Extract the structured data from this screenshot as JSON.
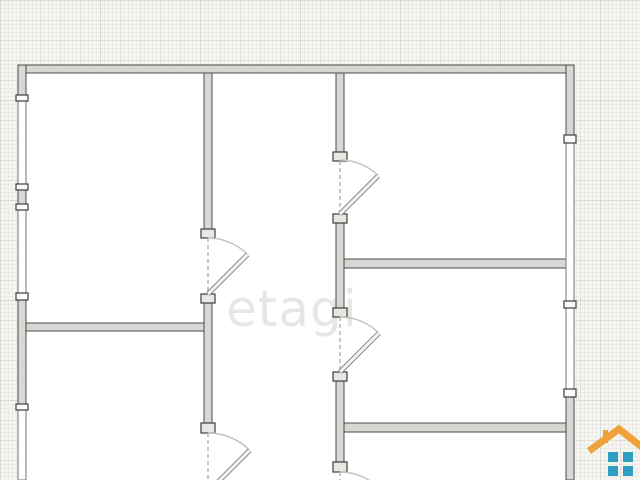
{
  "watermark": {
    "text": "etagi"
  },
  "logo": {
    "name": "house-logo",
    "roof_color": "#F0A23A",
    "pane_color": "#2E9FC0"
  },
  "plan": {
    "colors": {
      "wall_fill": "#D9D7D3",
      "wall_outline": "#4B4B4B",
      "interior": "#FFFFFF"
    },
    "rects": [
      {
        "t": "wall",
        "x": 18,
        "y": 65,
        "w": 556,
        "h": 8
      },
      {
        "t": "wall",
        "x": 18,
        "y": 65,
        "w": 8,
        "h": 30
      },
      {
        "t": "wall",
        "x": 18,
        "y": 190,
        "w": 8,
        "h": 14
      },
      {
        "t": "wall",
        "x": 18,
        "y": 300,
        "w": 8,
        "h": 104
      },
      {
        "t": "wall",
        "x": 566,
        "y": 65,
        "w": 8,
        "h": 70
      },
      {
        "t": "wall",
        "x": 566,
        "y": 397,
        "w": 8,
        "h": 83
      },
      {
        "t": "wall",
        "x": 204,
        "y": 73,
        "w": 8,
        "h": 157
      },
      {
        "t": "wall",
        "x": 204,
        "y": 303,
        "w": 8,
        "h": 120
      },
      {
        "t": "wall",
        "x": 336,
        "y": 73,
        "w": 8,
        "h": 79
      },
      {
        "t": "wall",
        "x": 336,
        "y": 223,
        "w": 8,
        "h": 86
      },
      {
        "t": "wall",
        "x": 336,
        "y": 381,
        "w": 8,
        "h": 81
      },
      {
        "t": "wall",
        "x": 26,
        "y": 323,
        "w": 178,
        "h": 8
      },
      {
        "t": "wall",
        "x": 344,
        "y": 259,
        "w": 222,
        "h": 9
      },
      {
        "t": "wall",
        "x": 344,
        "y": 423,
        "w": 222,
        "h": 9
      },
      {
        "t": "win",
        "x": 18,
        "y": 101,
        "w": 8,
        "h": 83
      },
      {
        "t": "win",
        "x": 18,
        "y": 210,
        "w": 8,
        "h": 83
      },
      {
        "t": "win",
        "x": 18,
        "y": 410,
        "w": 8,
        "h": 70
      },
      {
        "t": "win",
        "x": 566,
        "y": 143,
        "w": 8,
        "h": 158
      },
      {
        "t": "win",
        "x": 566,
        "y": 308,
        "w": 8,
        "h": 81
      },
      {
        "t": "cap",
        "x": 16,
        "y": 95,
        "w": 12,
        "h": 6
      },
      {
        "t": "cap",
        "x": 16,
        "y": 184,
        "w": 12,
        "h": 6
      },
      {
        "t": "cap",
        "x": 16,
        "y": 204,
        "w": 12,
        "h": 6
      },
      {
        "t": "cap",
        "x": 16,
        "y": 293,
        "w": 12,
        "h": 7
      },
      {
        "t": "cap",
        "x": 16,
        "y": 404,
        "w": 12,
        "h": 6
      },
      {
        "t": "cap",
        "x": 564,
        "y": 135,
        "w": 12,
        "h": 8
      },
      {
        "t": "cap",
        "x": 564,
        "y": 301,
        "w": 12,
        "h": 7
      },
      {
        "t": "cap",
        "x": 564,
        "y": 389,
        "w": 12,
        "h": 8
      },
      {
        "t": "jamb",
        "x": 201,
        "y": 229,
        "w": 14,
        "h": 9
      },
      {
        "t": "jamb",
        "x": 201,
        "y": 294,
        "w": 14,
        "h": 9
      },
      {
        "t": "jamb",
        "x": 201,
        "y": 423,
        "w": 14,
        "h": 10
      },
      {
        "t": "jamb",
        "x": 333,
        "y": 152,
        "w": 14,
        "h": 9
      },
      {
        "t": "jamb",
        "x": 333,
        "y": 214,
        "w": 14,
        "h": 9
      },
      {
        "t": "jamb",
        "x": 333,
        "y": 308,
        "w": 14,
        "h": 9
      },
      {
        "t": "jamb",
        "x": 333,
        "y": 372,
        "w": 14,
        "h": 9
      },
      {
        "t": "jamb",
        "x": 333,
        "y": 462,
        "w": 14,
        "h": 10
      }
    ],
    "openings": [
      {
        "x1": 208,
        "y1": 238,
        "x2": 208,
        "y2": 294
      },
      {
        "x1": 208,
        "y1": 433,
        "x2": 208,
        "y2": 480
      },
      {
        "x1": 340,
        "y1": 161,
        "x2": 340,
        "y2": 214
      },
      {
        "x1": 340,
        "y1": 317,
        "x2": 340,
        "y2": 372
      },
      {
        "x1": 340,
        "y1": 472,
        "x2": 340,
        "y2": 480
      }
    ],
    "arcs": [
      {
        "d": "M340,160 A54,54 0 0 1 378.2,175.8"
      },
      {
        "d": "M208,238 A56,56 0 0 1 247.6,254.4"
      },
      {
        "d": "M340,317 A55,55 0 0 1 378.9,333.1"
      },
      {
        "d": "M208,433 A59,59 0 0 1 249.7,450.3"
      },
      {
        "d": "M340,472 A56,56 0 0 1 379.6,488.4"
      }
    ],
    "leaves": [
      {
        "x1": 340,
        "y1": 214,
        "x2": 378.2,
        "y2": 175.8
      },
      {
        "x1": 208,
        "y1": 294,
        "x2": 247.6,
        "y2": 254.4
      },
      {
        "x1": 340,
        "y1": 372,
        "x2": 378.9,
        "y2": 333.1
      },
      {
        "x1": 208,
        "y1": 492,
        "x2": 249.7,
        "y2": 450.3
      }
    ]
  }
}
